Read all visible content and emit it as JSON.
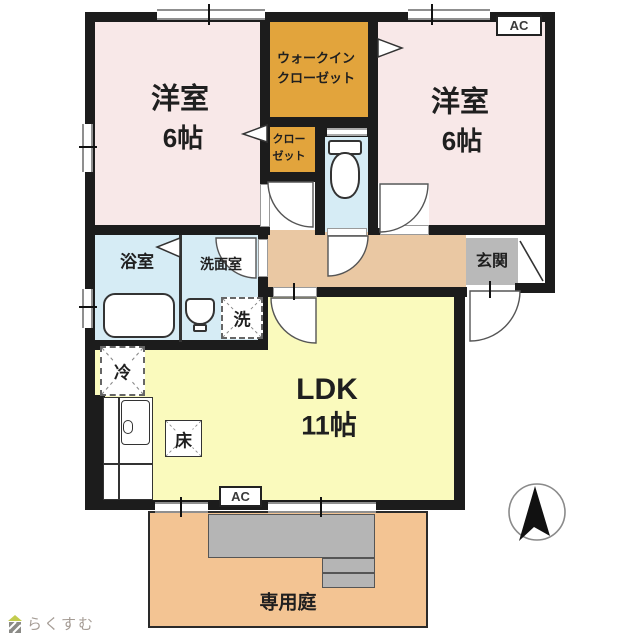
{
  "plan": {
    "bedroom1": {
      "name": "洋室",
      "size": "6帖"
    },
    "bedroom2": {
      "name": "洋室",
      "size": "6帖"
    },
    "walk_in_closet": {
      "line1": "ウォークイン",
      "line2": "クローゼット"
    },
    "closet": {
      "line1": "クロー",
      "line2": "ゼット"
    },
    "bathroom": {
      "label": "浴室"
    },
    "washroom": {
      "label": "洗面室"
    },
    "entrance": {
      "label": "玄関"
    },
    "ldk": {
      "name": "LDK",
      "size": "11帖"
    },
    "garden": {
      "label": "専用庭"
    },
    "fixtures": {
      "washing_machine": "洗",
      "refrigerator": "冷",
      "floor_storage": "床",
      "air_conditioner": "AC"
    }
  },
  "branding": {
    "logo_text": "らくすむ"
  },
  "colors": {
    "bedroom_pink": "#f8e8e8",
    "closet_orange": "#e2a43c",
    "wet_area_blue": "#d6ecf5",
    "hallway_tan": "#eac8a3",
    "ldk_yellow": "#fafabd",
    "entrance_gray": "#b9b9b9",
    "garden_orange": "#f3c493",
    "terrace_gray": "#b5b5b5",
    "wall_black": "#1c1c1c"
  }
}
